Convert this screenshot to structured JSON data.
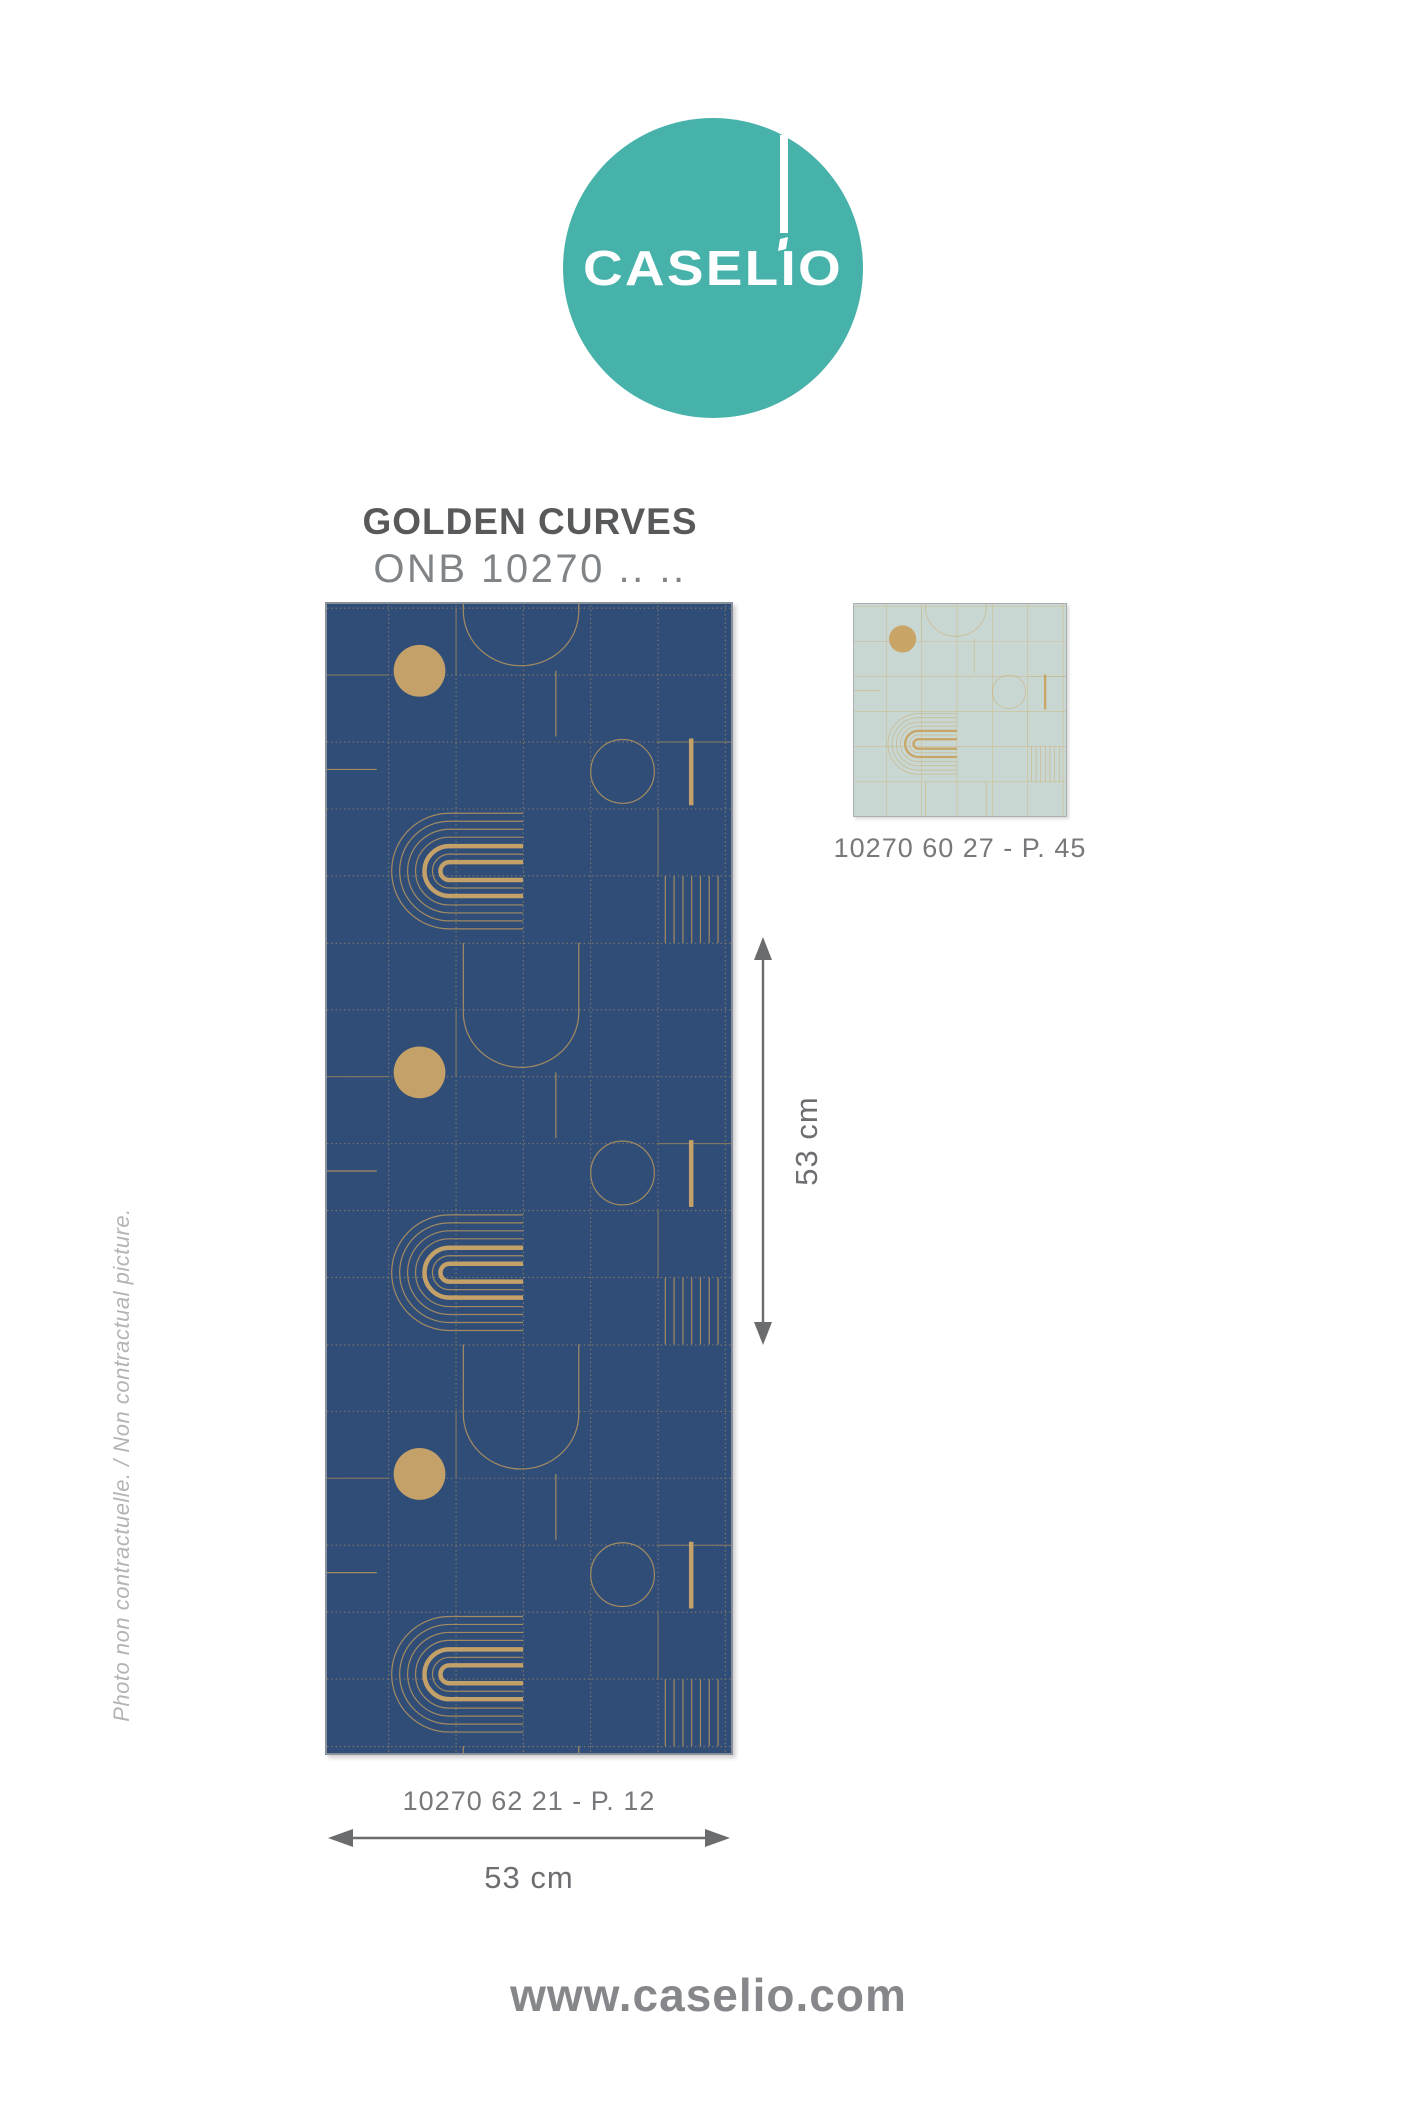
{
  "logo": {
    "brand": "CASELIO",
    "circle_color": "#47B2AA",
    "text_color": "#FFFFFF"
  },
  "product": {
    "name": "GOLDEN CURVES",
    "reference": "ONB 10270 .. .."
  },
  "main_swatch": {
    "caption": "10270 62 21 - P. 12",
    "width_label": "53 cm",
    "height_label": "53 cm",
    "colors": {
      "bg": "#304D78",
      "gold": "#C3A169",
      "thin": "#A38B61",
      "grid": "#9A8560",
      "solid_grid": "#897B60"
    }
  },
  "alt_swatch": {
    "caption": "10270 60 27 - P. 45",
    "colors": {
      "bg": "#C9D7D2",
      "gold": "#C8A466",
      "thin": "#CBB586",
      "grid": "#CEBC8E",
      "solid_grid": "#C2B283"
    }
  },
  "arrows": {
    "color": "#6B6C6E"
  },
  "side_note": "Photo non contractuelle. / Non contractual picture.",
  "footer": {
    "url": "www.caselio.com"
  }
}
